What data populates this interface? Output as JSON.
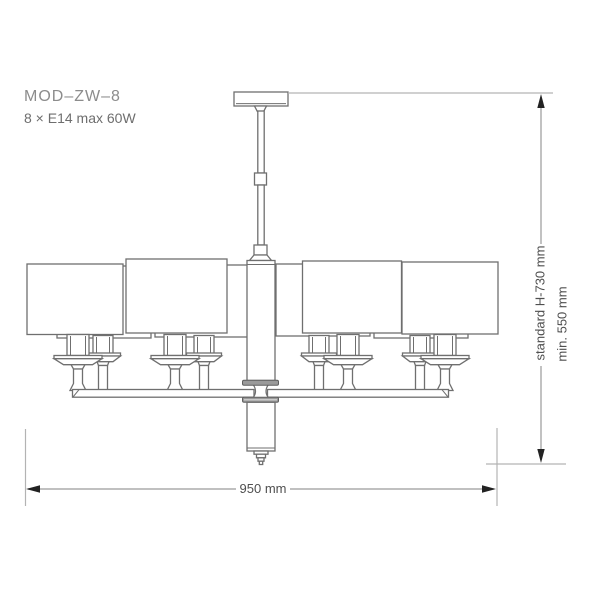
{
  "product": {
    "model": "MOD–ZW–8",
    "lamp_spec": "8 × E14 max 60W"
  },
  "dimensions": {
    "width_label": "950 mm",
    "width_value_mm": 950,
    "height_standard_label": "standard H-730 mm",
    "height_standard_value_mm": 730,
    "height_min_label": "min. 550 mm",
    "height_min_value_mm": 550
  },
  "figure": {
    "name": "eight-arm-chandelier-technical-line-drawing"
  },
  "colors": {
    "background": "#ffffff",
    "outline": "#6f6f6f",
    "hub_fill": "#9a9a9a",
    "hub_stroke": "#5e5e5e",
    "extension_line": "#b3b3b3",
    "dimension_line": "#9a9a9a",
    "arrow": "#222222",
    "text_model": "#8c8c8c",
    "text_spec": "#6e6e6e",
    "text_dim": "#4f4f4f"
  }
}
